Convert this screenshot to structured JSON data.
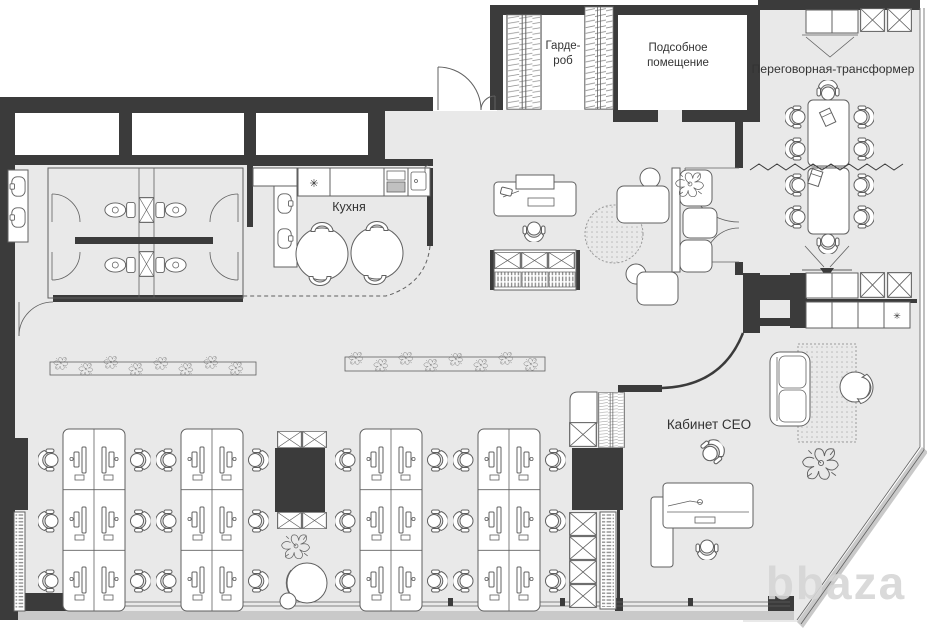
{
  "palette": {
    "wall": "#3b3b3b",
    "floor": "#e9e9e9",
    "line": "#606060",
    "slab": "#c9c9c9",
    "white": "#ffffff",
    "text": "#333333",
    "watermark": "#d6d6d6"
  },
  "labels": {
    "wardrobe_l1": "Гарде-",
    "wardrobe_l2": "роб",
    "utility_l1": "Подсобное",
    "utility_l2": "помещение",
    "meeting_room": "Переговорная-трансформер",
    "kitchen": "Кухня",
    "ceo_office": "Кабинет CEO",
    "fridge_symbol": "✳",
    "watermark": "bbaza"
  }
}
